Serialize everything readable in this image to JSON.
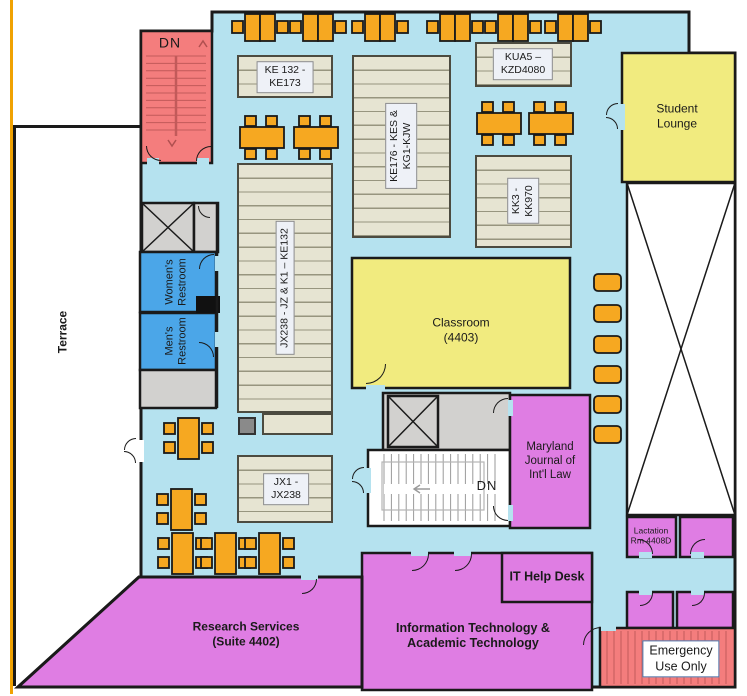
{
  "colors": {
    "floor": "#B5E2EF",
    "stairs_red": "#F47D7D",
    "room_yellow": "#F1EB7F",
    "room_magenta": "#DF7DE3",
    "restroom_blue": "#4BA6E8",
    "furniture_orange": "#F6A821",
    "stack_beige": "#E6E4D2",
    "elevator_gray": "#D2D1CF",
    "wall": "#1A1A1A",
    "accent_line": "#F0A202"
  },
  "labels": {
    "stairwell_nw": "DN",
    "stairwell_center": "DN",
    "terrace": "Terrace",
    "womens_restroom": {
      "line1": "Women's",
      "line2": "Restroom"
    },
    "mens_restroom": {
      "line1": "Men's",
      "line2": "Restroom"
    },
    "student_lounge": {
      "line1": "Student",
      "line2": "Lounge"
    },
    "classroom": {
      "line1": "Classroom",
      "line2": "(4403)"
    },
    "maryland_journal": {
      "line1": "Maryland",
      "line2": "Journal of",
      "line3": "Int'l Law"
    },
    "it_help_desk": "IT Help Desk",
    "it_dept": {
      "line1": "Information Technology &",
      "line2": "Academic Technology"
    },
    "research_services": {
      "line1": "Research Services",
      "line2": "(Suite 4402)"
    },
    "lactation": {
      "line1": "Lactation",
      "line2": "Rm 4408D"
    },
    "emergency": {
      "line1": "Emergency",
      "line2": "Use Only"
    }
  },
  "stacks": {
    "ke132_ke173": {
      "line1": "KE 132 -",
      "line2": "KE173"
    },
    "kua5_kzd4080": {
      "line1": "KUA5 –",
      "line2": "KZD4080"
    },
    "ke176_kg1": {
      "line1": "KE176 - KES &",
      "line2": "KG1-KJW"
    },
    "kk3_kk970": {
      "line1": "KK3 -",
      "line2": "KK970"
    },
    "jx238_ke132": {
      "line1": "JX238 - JZ & K1 – KE132"
    },
    "jx1_jx238": {
      "line1": "JX1 -",
      "line2": "JX238"
    }
  }
}
